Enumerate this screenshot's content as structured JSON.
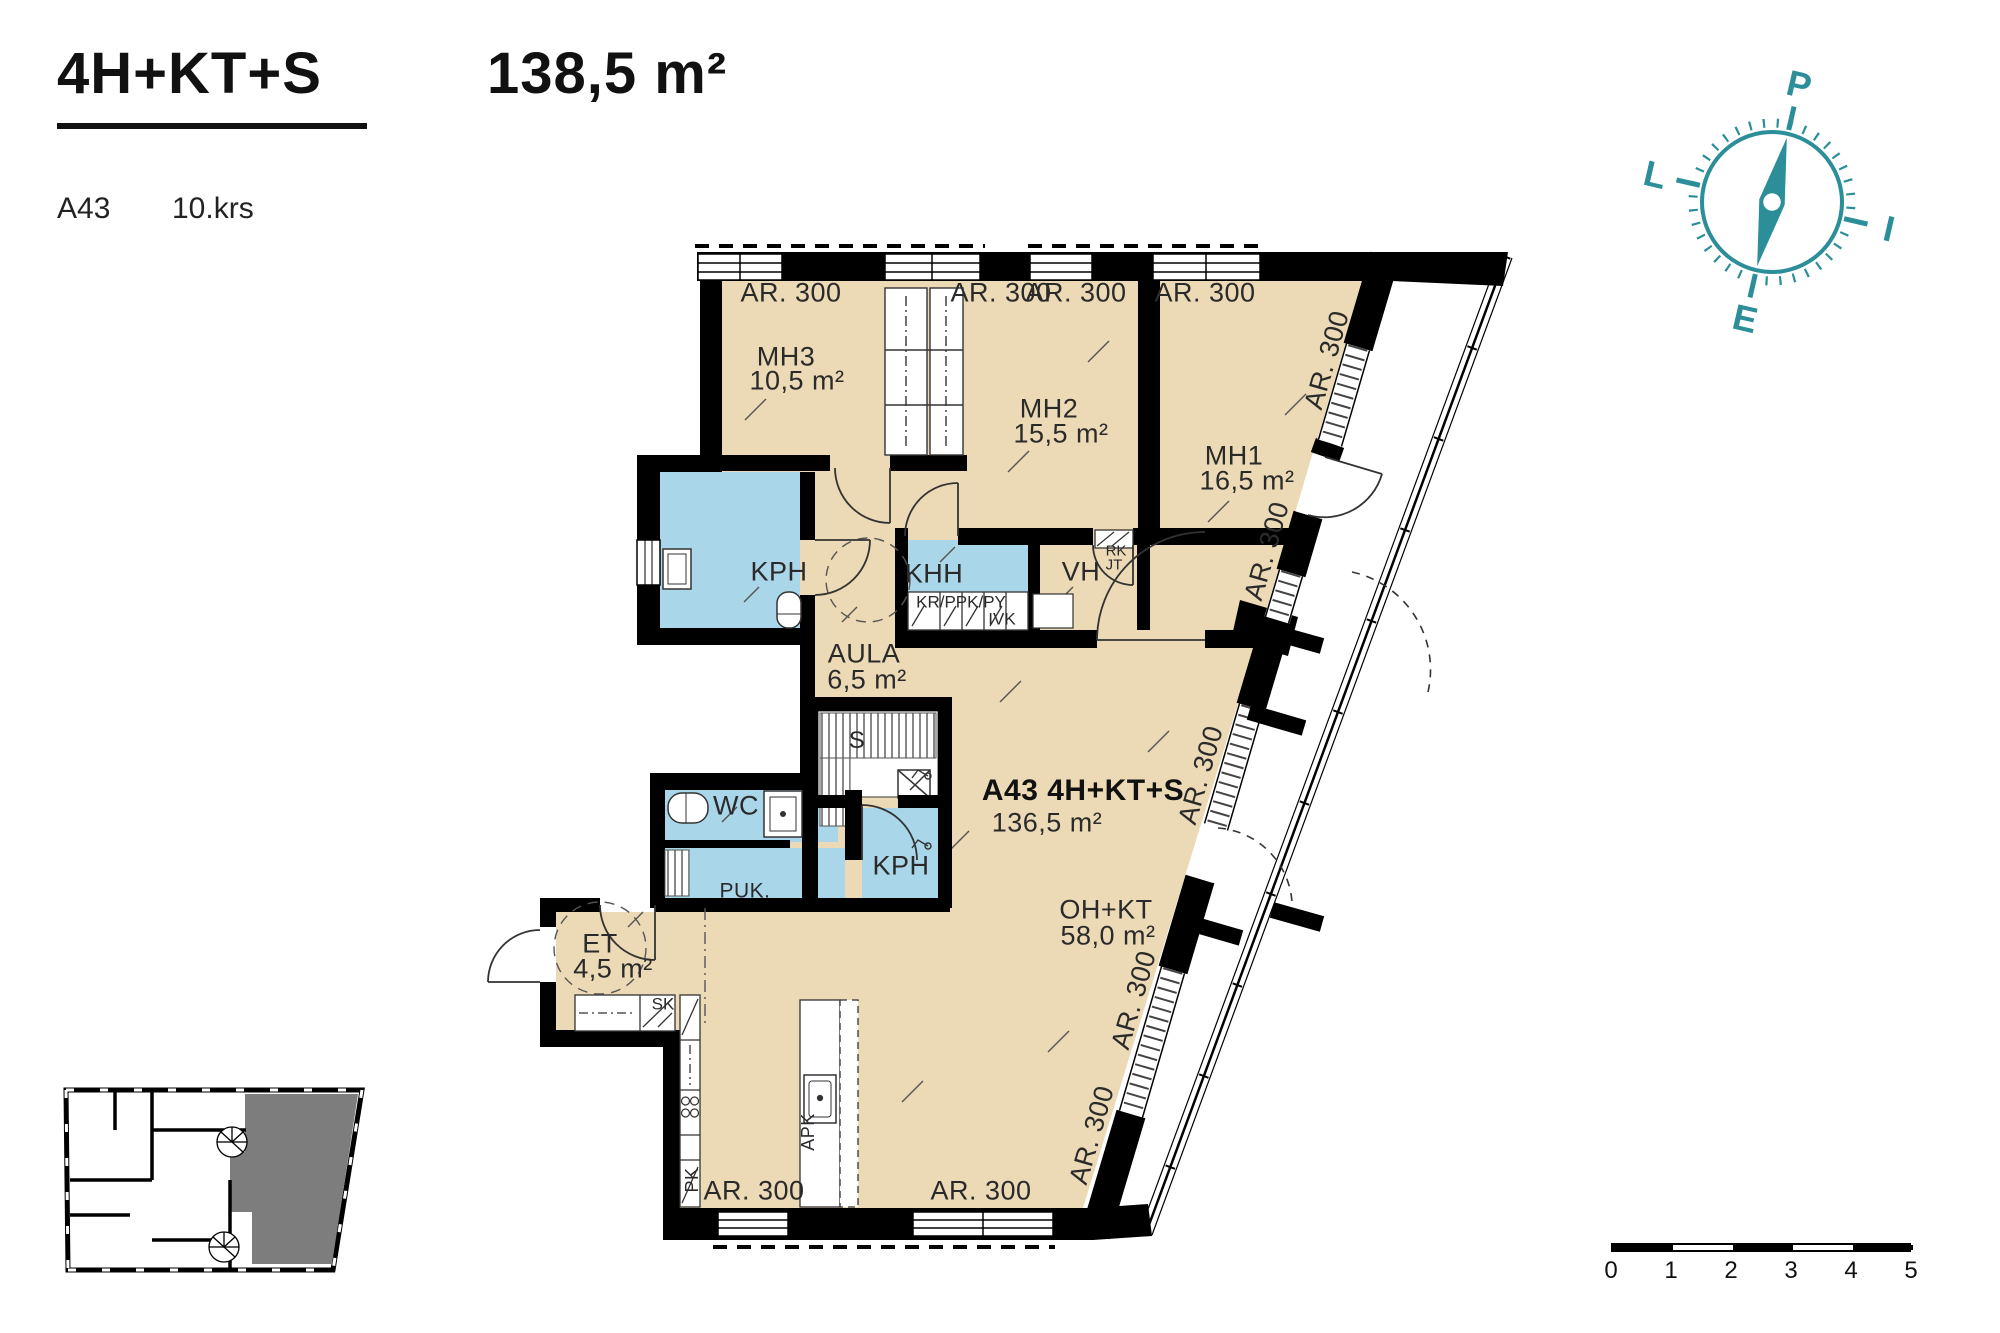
{
  "header": {
    "type_label": "4H+KT+S",
    "area_label": "138,5 m²",
    "apartment_id": "A43",
    "floor": "10.krs"
  },
  "compass": {
    "north": "P",
    "east": "I",
    "south": "E",
    "west": "L"
  },
  "rooms": {
    "mh3": {
      "name": "MH3",
      "area": "10,5 m²"
    },
    "mh2": {
      "name": "MH2",
      "area": "15,5 m²"
    },
    "mh1": {
      "name": "MH1",
      "area": "16,5 m²"
    },
    "kph_top": {
      "name": "KPH"
    },
    "khh": {
      "name": "KHH"
    },
    "vh": {
      "name": "VH"
    },
    "aula": {
      "name": "AULA",
      "area": "6,5 m²"
    },
    "sauna": {
      "name": "S"
    },
    "wc": {
      "name": "WC"
    },
    "puk": {
      "name": "PUK."
    },
    "kph_lower": {
      "name": "KPH"
    },
    "et": {
      "name": "ET",
      "area": "4,5 m²"
    },
    "ohkt": {
      "name": "OH+KT",
      "area": "58,0 m²"
    },
    "apartment": {
      "name": "A43 4H+KT+S",
      "area": "136,5 m²"
    }
  },
  "fixtures": {
    "rk": "RK",
    "jt": "JT",
    "kr_ppk_py": "KR/PPK/PY",
    "ivk": "IVK",
    "sk": "SK",
    "pk": "PK",
    "apk": "APK"
  },
  "wall_label": "AR. 300",
  "scale_bar": {
    "ticks": [
      "0",
      "1",
      "2",
      "3",
      "4",
      "5"
    ]
  },
  "colors": {
    "room": "#ecd9b5",
    "wet_room": "#a9d6e8",
    "wall": "#000000",
    "compass": "#2b8e99",
    "locator_highlight": "#7d7d7d"
  }
}
